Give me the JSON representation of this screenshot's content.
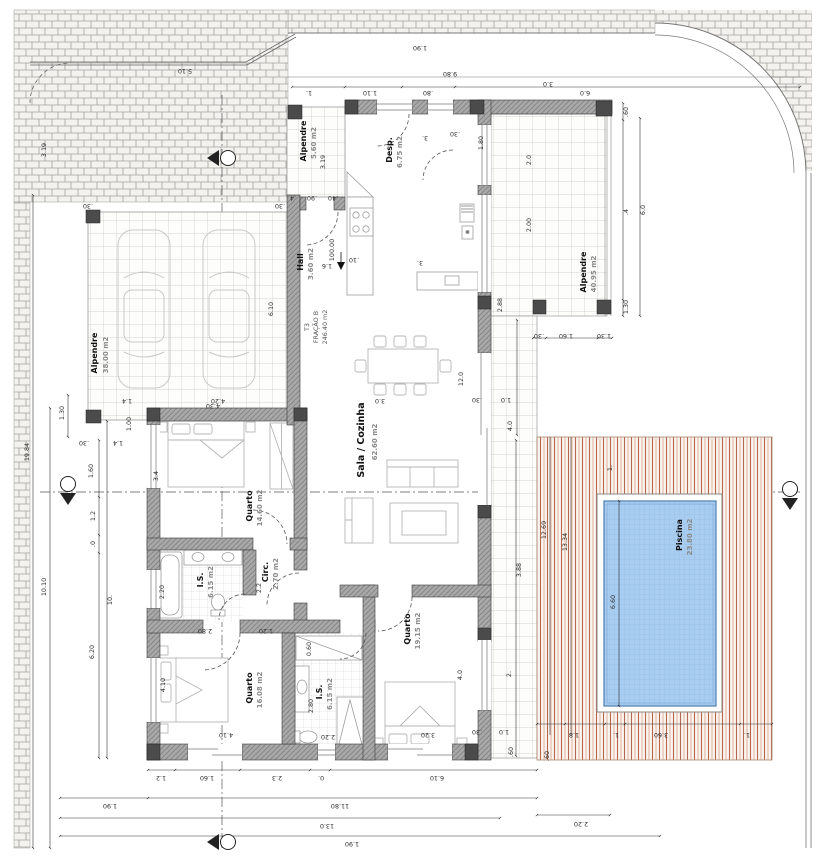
{
  "drawing": {
    "fraction": {
      "l1": "T3",
      "l2": "FRAÇÃO B",
      "l3": "246.40 m2"
    },
    "rooms": [
      {
        "name": "Alpendre",
        "area": "38.00 m2"
      },
      {
        "name": "Alpendre",
        "area": "5.60 m2"
      },
      {
        "name": "Hall",
        "area": "3.60 m2"
      },
      {
        "name": "Desp.",
        "area": "6.75 m2"
      },
      {
        "name": "Sala / Cozinha",
        "area": "62.60 m2"
      },
      {
        "name": "Quarto",
        "area": "14.60 m2"
      },
      {
        "name": "I.S.",
        "area": "6.15 m2"
      },
      {
        "name": "Circ.",
        "area": "2.70 m2"
      },
      {
        "name": "Quarto",
        "area": "16.08 m2"
      },
      {
        "name": "I.S.",
        "area": "6.15 m2"
      },
      {
        "name": "Quarto",
        "area": "19.15 m2"
      },
      {
        "name": "Alpendre",
        "area": "40.95 m2"
      },
      {
        "name": "Piscina",
        "area": "23.80 m2"
      }
    ],
    "dims": {
      "top": [
        "1.90",
        "9.80",
        "5.10",
        "1.",
        "1.10",
        ".80",
        "6.0"
      ],
      "bottom": [
        "1.2",
        "1.60",
        "2.3",
        "0.",
        "6.10",
        "1.90",
        "11.80",
        "13.0",
        "1.90"
      ],
      "left": [
        "3.19",
        "19.84",
        "10.10",
        "1.30",
        ".30",
        "1.00",
        "1.4",
        "1.60",
        "1.2",
        ".0",
        "10.",
        "6.20"
      ],
      "right": [
        ".60",
        "6.0",
        ".4",
        "1.30",
        "3.0",
        "2.0",
        "2.00",
        "2.88",
        ".30",
        "1.60",
        "1.30",
        "4.0",
        "1.0",
        ".30",
        "3.88",
        "2.",
        "1.0",
        ".30",
        ".60",
        ".60"
      ],
      "pool": [
        "12.69",
        "13.34",
        "6.60",
        "1.",
        "1.8",
        "1.",
        "3.60",
        "1.",
        "2.20"
      ],
      "interior": [
        "6.10",
        "4.20",
        "1.4",
        ".30",
        ".30",
        ".4",
        ".90",
        ".40",
        "3.",
        ".30",
        "1.80",
        "100.00",
        "1.6",
        ".10",
        "3.",
        "12.0",
        "3.0",
        "4.30",
        "3.4",
        "2.20",
        "2.2",
        "2.80",
        "1.20",
        "4.10",
        "4.10",
        "0.60",
        "2.80",
        "2.20",
        "4.0",
        "3.20",
        "3.19"
      ]
    },
    "colors": {
      "pool_water": "#a9cdf1",
      "deck_stripe": "#b4674f",
      "wall_fill": "#a9a9a9",
      "brick_bg": "#f4f2ef"
    }
  }
}
